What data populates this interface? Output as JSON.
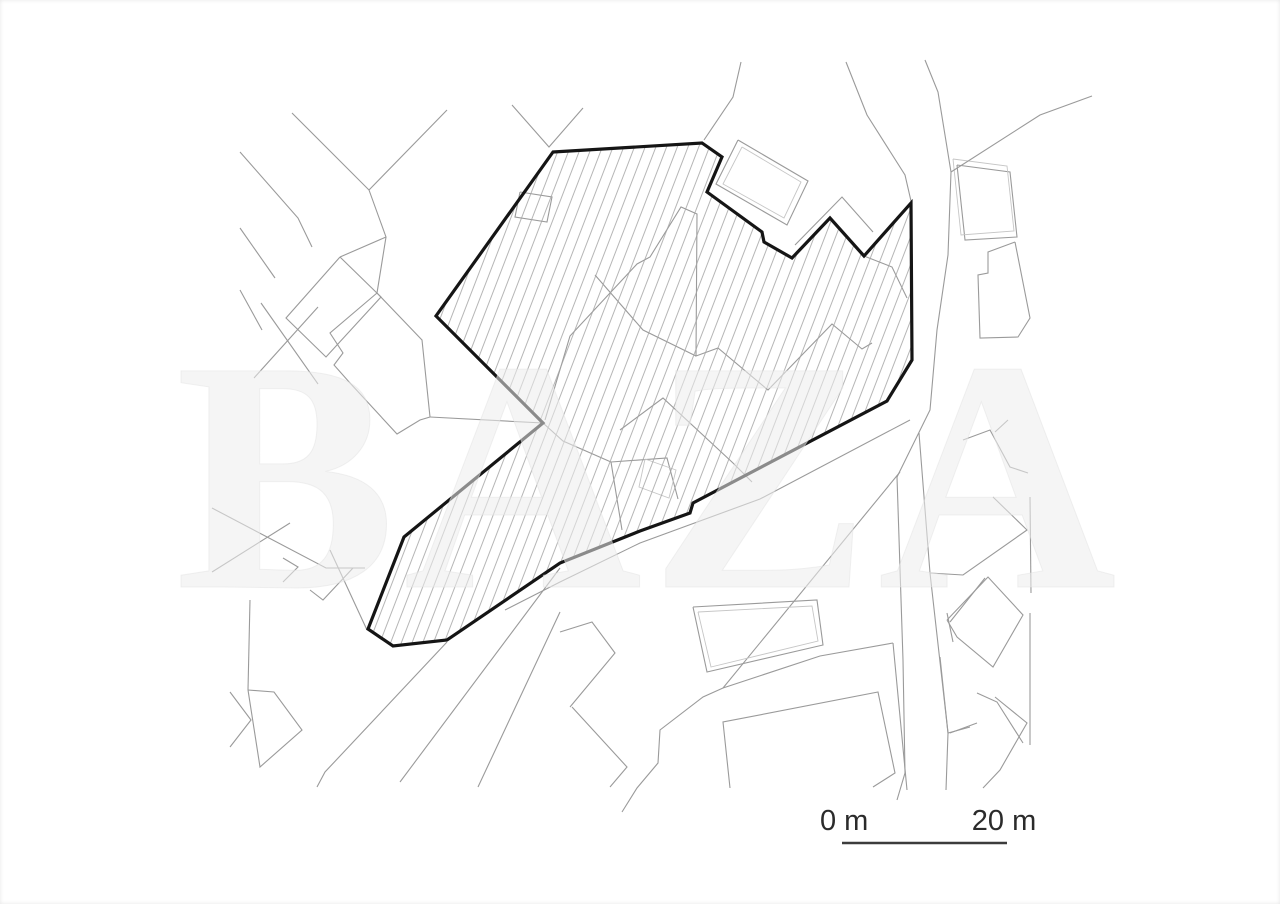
{
  "page": {
    "background": "#ffffff"
  },
  "watermark": {
    "text": "BAZA",
    "color": "#ececec",
    "edge_color": "#e0e0e0"
  },
  "scale_bar": {
    "start_label": "0 m",
    "end_label": "20 m",
    "x1": 842,
    "x2": 1007,
    "y": 843,
    "label_y": 830,
    "start_label_x": 820,
    "end_label_x": 1004,
    "color": "#3c3c3c"
  },
  "site_plan": {
    "canvas": {
      "width": 1280,
      "height": 904
    },
    "colors": {
      "site_outline": "#151515",
      "map_line": "#9a9a9a",
      "map_line_light": "#c6c6c6",
      "hatch": "#a3a3a3"
    },
    "hatch": {
      "spacing": 10,
      "angle": 21,
      "stroke_width": 0.8
    },
    "site_boundary": [
      [
        553,
        152
      ],
      [
        702,
        143
      ],
      [
        722,
        157
      ],
      [
        707,
        192
      ],
      [
        762,
        232
      ],
      [
        764,
        242
      ],
      [
        792,
        258
      ],
      [
        830,
        218
      ],
      [
        864,
        256
      ],
      [
        911,
        203
      ],
      [
        912,
        360
      ],
      [
        887,
        401
      ],
      [
        693,
        503
      ],
      [
        690,
        513
      ],
      [
        640,
        531
      ],
      [
        560,
        563
      ],
      [
        447,
        640
      ],
      [
        393,
        646
      ],
      [
        368,
        629
      ],
      [
        404,
        537
      ],
      [
        543,
        423
      ],
      [
        436,
        316
      ]
    ],
    "map_lines": [
      {
        "points": [
          [
            292,
            113
          ],
          [
            369,
            190
          ],
          [
            386,
            237
          ],
          [
            377,
            293
          ]
        ]
      },
      {
        "points": [
          [
            447,
            110
          ],
          [
            369,
            190
          ]
        ]
      },
      {
        "points": [
          [
            240,
            152
          ],
          [
            298,
            218
          ],
          [
            312,
            247
          ]
        ]
      },
      {
        "points": [
          [
            340,
            257
          ],
          [
            381,
            297
          ],
          [
            326,
            357
          ],
          [
            286,
            318
          ],
          [
            340,
            257
          ]
        ]
      },
      {
        "points": [
          [
            386,
            237
          ],
          [
            340,
            257
          ]
        ]
      },
      {
        "points": [
          [
            240,
            228
          ],
          [
            275,
            278
          ]
        ]
      },
      {
        "points": [
          [
            261,
            303
          ],
          [
            318,
            384
          ]
        ]
      },
      {
        "points": [
          [
            318,
            307
          ],
          [
            254,
            378
          ]
        ]
      },
      {
        "points": [
          [
            240,
            290
          ],
          [
            262,
            330
          ]
        ]
      },
      {
        "points": [
          [
            377,
            293
          ],
          [
            330,
            333
          ],
          [
            343,
            353
          ],
          [
            334,
            365
          ],
          [
            350,
            383
          ],
          [
            397,
            434
          ],
          [
            420,
            420
          ],
          [
            430,
            417
          ],
          [
            422,
            340
          ],
          [
            377,
            293
          ]
        ]
      },
      {
        "points": [
          [
            430,
            417
          ],
          [
            543,
            423
          ]
        ]
      },
      {
        "points": [
          [
            330,
            550
          ],
          [
            367,
            630
          ]
        ]
      },
      {
        "points": [
          [
            212,
            508
          ],
          [
            326,
            568
          ],
          [
            365,
            568
          ]
        ]
      },
      {
        "points": [
          [
            290,
            523
          ],
          [
            212,
            572
          ]
        ]
      },
      {
        "points": [
          [
            283,
            558
          ],
          [
            298,
            567
          ],
          [
            283,
            582
          ]
        ]
      },
      {
        "points": [
          [
            353,
            568
          ],
          [
            323,
            600
          ],
          [
            310,
            590
          ]
        ]
      },
      {
        "points": [
          [
            250,
            600
          ],
          [
            248,
            690
          ]
        ]
      },
      {
        "points": [
          [
            248,
            690
          ],
          [
            274,
            692
          ],
          [
            302,
            730
          ],
          [
            260,
            767
          ],
          [
            248,
            690
          ]
        ]
      },
      {
        "points": [
          [
            230,
            692
          ],
          [
            251,
            720
          ],
          [
            230,
            747
          ]
        ]
      },
      {
        "points": [
          [
            447,
            642
          ],
          [
            325,
            772
          ],
          [
            317,
            787
          ]
        ]
      },
      {
        "points": [
          [
            560,
            568
          ],
          [
            400,
            782
          ]
        ]
      },
      {
        "points": [
          [
            560,
            612
          ],
          [
            478,
            787
          ]
        ]
      },
      {
        "points": [
          [
            560,
            632
          ],
          [
            592,
            622
          ],
          [
            615,
            653
          ],
          [
            570,
            707
          ]
        ]
      },
      {
        "points": [
          [
            572,
            707
          ],
          [
            627,
            767
          ],
          [
            610,
            787
          ]
        ]
      },
      {
        "points": [
          [
            893,
            643
          ],
          [
            820,
            656
          ],
          [
            723,
            688
          ],
          [
            703,
            697
          ],
          [
            660,
            730
          ],
          [
            658,
            763
          ],
          [
            637,
            788
          ],
          [
            622,
            812
          ]
        ]
      },
      {
        "points": [
          [
            730,
            788
          ],
          [
            723,
            722
          ],
          [
            878,
            692
          ],
          [
            895,
            773
          ],
          [
            873,
            787
          ]
        ]
      },
      {
        "points": [
          [
            893,
            643
          ],
          [
            907,
            790
          ]
        ]
      },
      {
        "points": [
          [
            947,
            613
          ],
          [
            953,
            642
          ]
        ]
      },
      {
        "points": [
          [
            910,
            420
          ],
          [
            760,
            499
          ],
          [
            640,
            543
          ],
          [
            560,
            582
          ],
          [
            505,
            610
          ]
        ]
      },
      {
        "points": [
          [
            900,
            472
          ],
          [
            723,
            688
          ]
        ]
      },
      {
        "points": [
          [
            846,
            62
          ],
          [
            867,
            115
          ],
          [
            905,
            175
          ],
          [
            911,
            201
          ]
        ]
      },
      {
        "points": [
          [
            925,
            60
          ],
          [
            938,
            92
          ],
          [
            951,
            172
          ],
          [
            948,
            255
          ],
          [
            937,
            330
          ],
          [
            930,
            410
          ],
          [
            897,
            477
          ],
          [
            903,
            660
          ],
          [
            905,
            773
          ],
          [
            897,
            800
          ]
        ]
      },
      {
        "points": [
          [
            919,
            433
          ],
          [
            930,
            573
          ],
          [
            948,
            733
          ],
          [
            946,
            790
          ]
        ]
      },
      {
        "points": [
          [
            957,
            165
          ],
          [
            1010,
            172
          ],
          [
            1017,
            237
          ],
          [
            965,
            240
          ],
          [
            957,
            165
          ]
        ]
      },
      {
        "points": [
          [
            953,
            159
          ],
          [
            1007,
            166
          ],
          [
            1014,
            231
          ],
          [
            961,
            235
          ],
          [
            953,
            159
          ]
        ],
        "light": true
      },
      {
        "points": [
          [
            1015,
            242
          ],
          [
            988,
            252
          ],
          [
            988,
            273
          ],
          [
            978,
            275
          ],
          [
            980,
            338
          ],
          [
            1018,
            337
          ],
          [
            1030,
            318
          ],
          [
            1015,
            242
          ]
        ]
      },
      {
        "points": [
          [
            512,
            105
          ],
          [
            549,
            147
          ],
          [
            583,
            108
          ]
        ]
      },
      {
        "points": [
          [
            704,
            140
          ],
          [
            733,
            97
          ],
          [
            741,
            62
          ]
        ]
      },
      {
        "points": [
          [
            738,
            140
          ],
          [
            808,
            181
          ],
          [
            787,
            225
          ],
          [
            716,
            184
          ],
          [
            738,
            140
          ]
        ]
      },
      {
        "points": [
          [
            742,
            147
          ],
          [
            801,
            182
          ],
          [
            784,
            218
          ],
          [
            723,
            184
          ],
          [
            742,
            147
          ]
        ],
        "light": true
      },
      {
        "points": [
          [
            795,
            245
          ],
          [
            842,
            197
          ],
          [
            873,
            232
          ]
        ]
      },
      {
        "points": [
          [
            951,
            172
          ],
          [
            1040,
            115
          ],
          [
            1092,
            96
          ]
        ]
      },
      {
        "points": [
          [
            520,
            192
          ],
          [
            552,
            197
          ],
          [
            547,
            222
          ],
          [
            515,
            217
          ],
          [
            520,
            192
          ]
        ]
      },
      {
        "points": [
          [
            545,
            420
          ],
          [
            570,
            336
          ],
          [
            637,
            264
          ],
          [
            650,
            257
          ],
          [
            681,
            207
          ],
          [
            697,
            214
          ],
          [
            696,
            356
          ],
          [
            718,
            348
          ],
          [
            768,
            390
          ],
          [
            832,
            324
          ],
          [
            862,
            349
          ],
          [
            872,
            343
          ]
        ]
      },
      {
        "points": [
          [
            864,
            256
          ],
          [
            892,
            267
          ],
          [
            907,
            298
          ]
        ]
      },
      {
        "points": [
          [
            595,
            275
          ],
          [
            643,
            330
          ],
          [
            696,
            356
          ]
        ]
      },
      {
        "points": [
          [
            543,
            423
          ],
          [
            563,
            441
          ],
          [
            611,
            462
          ],
          [
            622,
            530
          ]
        ]
      },
      {
        "points": [
          [
            611,
            462
          ],
          [
            667,
            458
          ],
          [
            678,
            499
          ]
        ]
      },
      {
        "points": [
          [
            620,
            430
          ],
          [
            663,
            398
          ],
          [
            733,
            463
          ],
          [
            752,
            482
          ]
        ]
      },
      {
        "points": [
          [
            645,
            459
          ],
          [
            676,
            470
          ],
          [
            669,
            498
          ],
          [
            639,
            487
          ],
          [
            645,
            459
          ]
        ],
        "light": true
      },
      {
        "points": [
          [
            693,
            607
          ],
          [
            817,
            600
          ],
          [
            823,
            645
          ],
          [
            707,
            672
          ],
          [
            693,
            607
          ]
        ]
      },
      {
        "points": [
          [
            698,
            612
          ],
          [
            812,
            606
          ],
          [
            818,
            641
          ],
          [
            711,
            667
          ],
          [
            698,
            612
          ]
        ],
        "light": true
      },
      {
        "points": [
          [
            963,
            440
          ],
          [
            990,
            430
          ],
          [
            1010,
            467
          ],
          [
            1028,
            473
          ]
        ]
      },
      {
        "points": [
          [
            995,
            432
          ],
          [
            1008,
            420
          ]
        ]
      },
      {
        "points": [
          [
            993,
            497
          ],
          [
            1027,
            530
          ],
          [
            963,
            575
          ],
          [
            930,
            573
          ]
        ]
      },
      {
        "points": [
          [
            947,
            620
          ],
          [
            988,
            577
          ],
          [
            1023,
            615
          ],
          [
            993,
            667
          ],
          [
            957,
            637
          ],
          [
            947,
            620
          ]
        ]
      },
      {
        "points": [
          [
            977,
            693
          ],
          [
            997,
            702
          ],
          [
            1023,
            743
          ]
        ]
      },
      {
        "points": [
          [
            940,
            657
          ],
          [
            948,
            733
          ],
          [
            970,
            727
          ]
        ]
      },
      {
        "points": [
          [
            1030,
            497
          ],
          [
            1031,
            593
          ]
        ]
      },
      {
        "points": [
          [
            1030,
            613
          ],
          [
            1030,
            745
          ]
        ]
      },
      {
        "points": [
          [
            985,
            578
          ],
          [
            950,
            622
          ]
        ]
      },
      {
        "points": [
          [
            995,
            697
          ],
          [
            1027,
            723
          ],
          [
            1000,
            770
          ],
          [
            983,
            788
          ]
        ]
      },
      {
        "points": [
          [
            950,
            733
          ],
          [
            977,
            723
          ]
        ]
      }
    ]
  }
}
